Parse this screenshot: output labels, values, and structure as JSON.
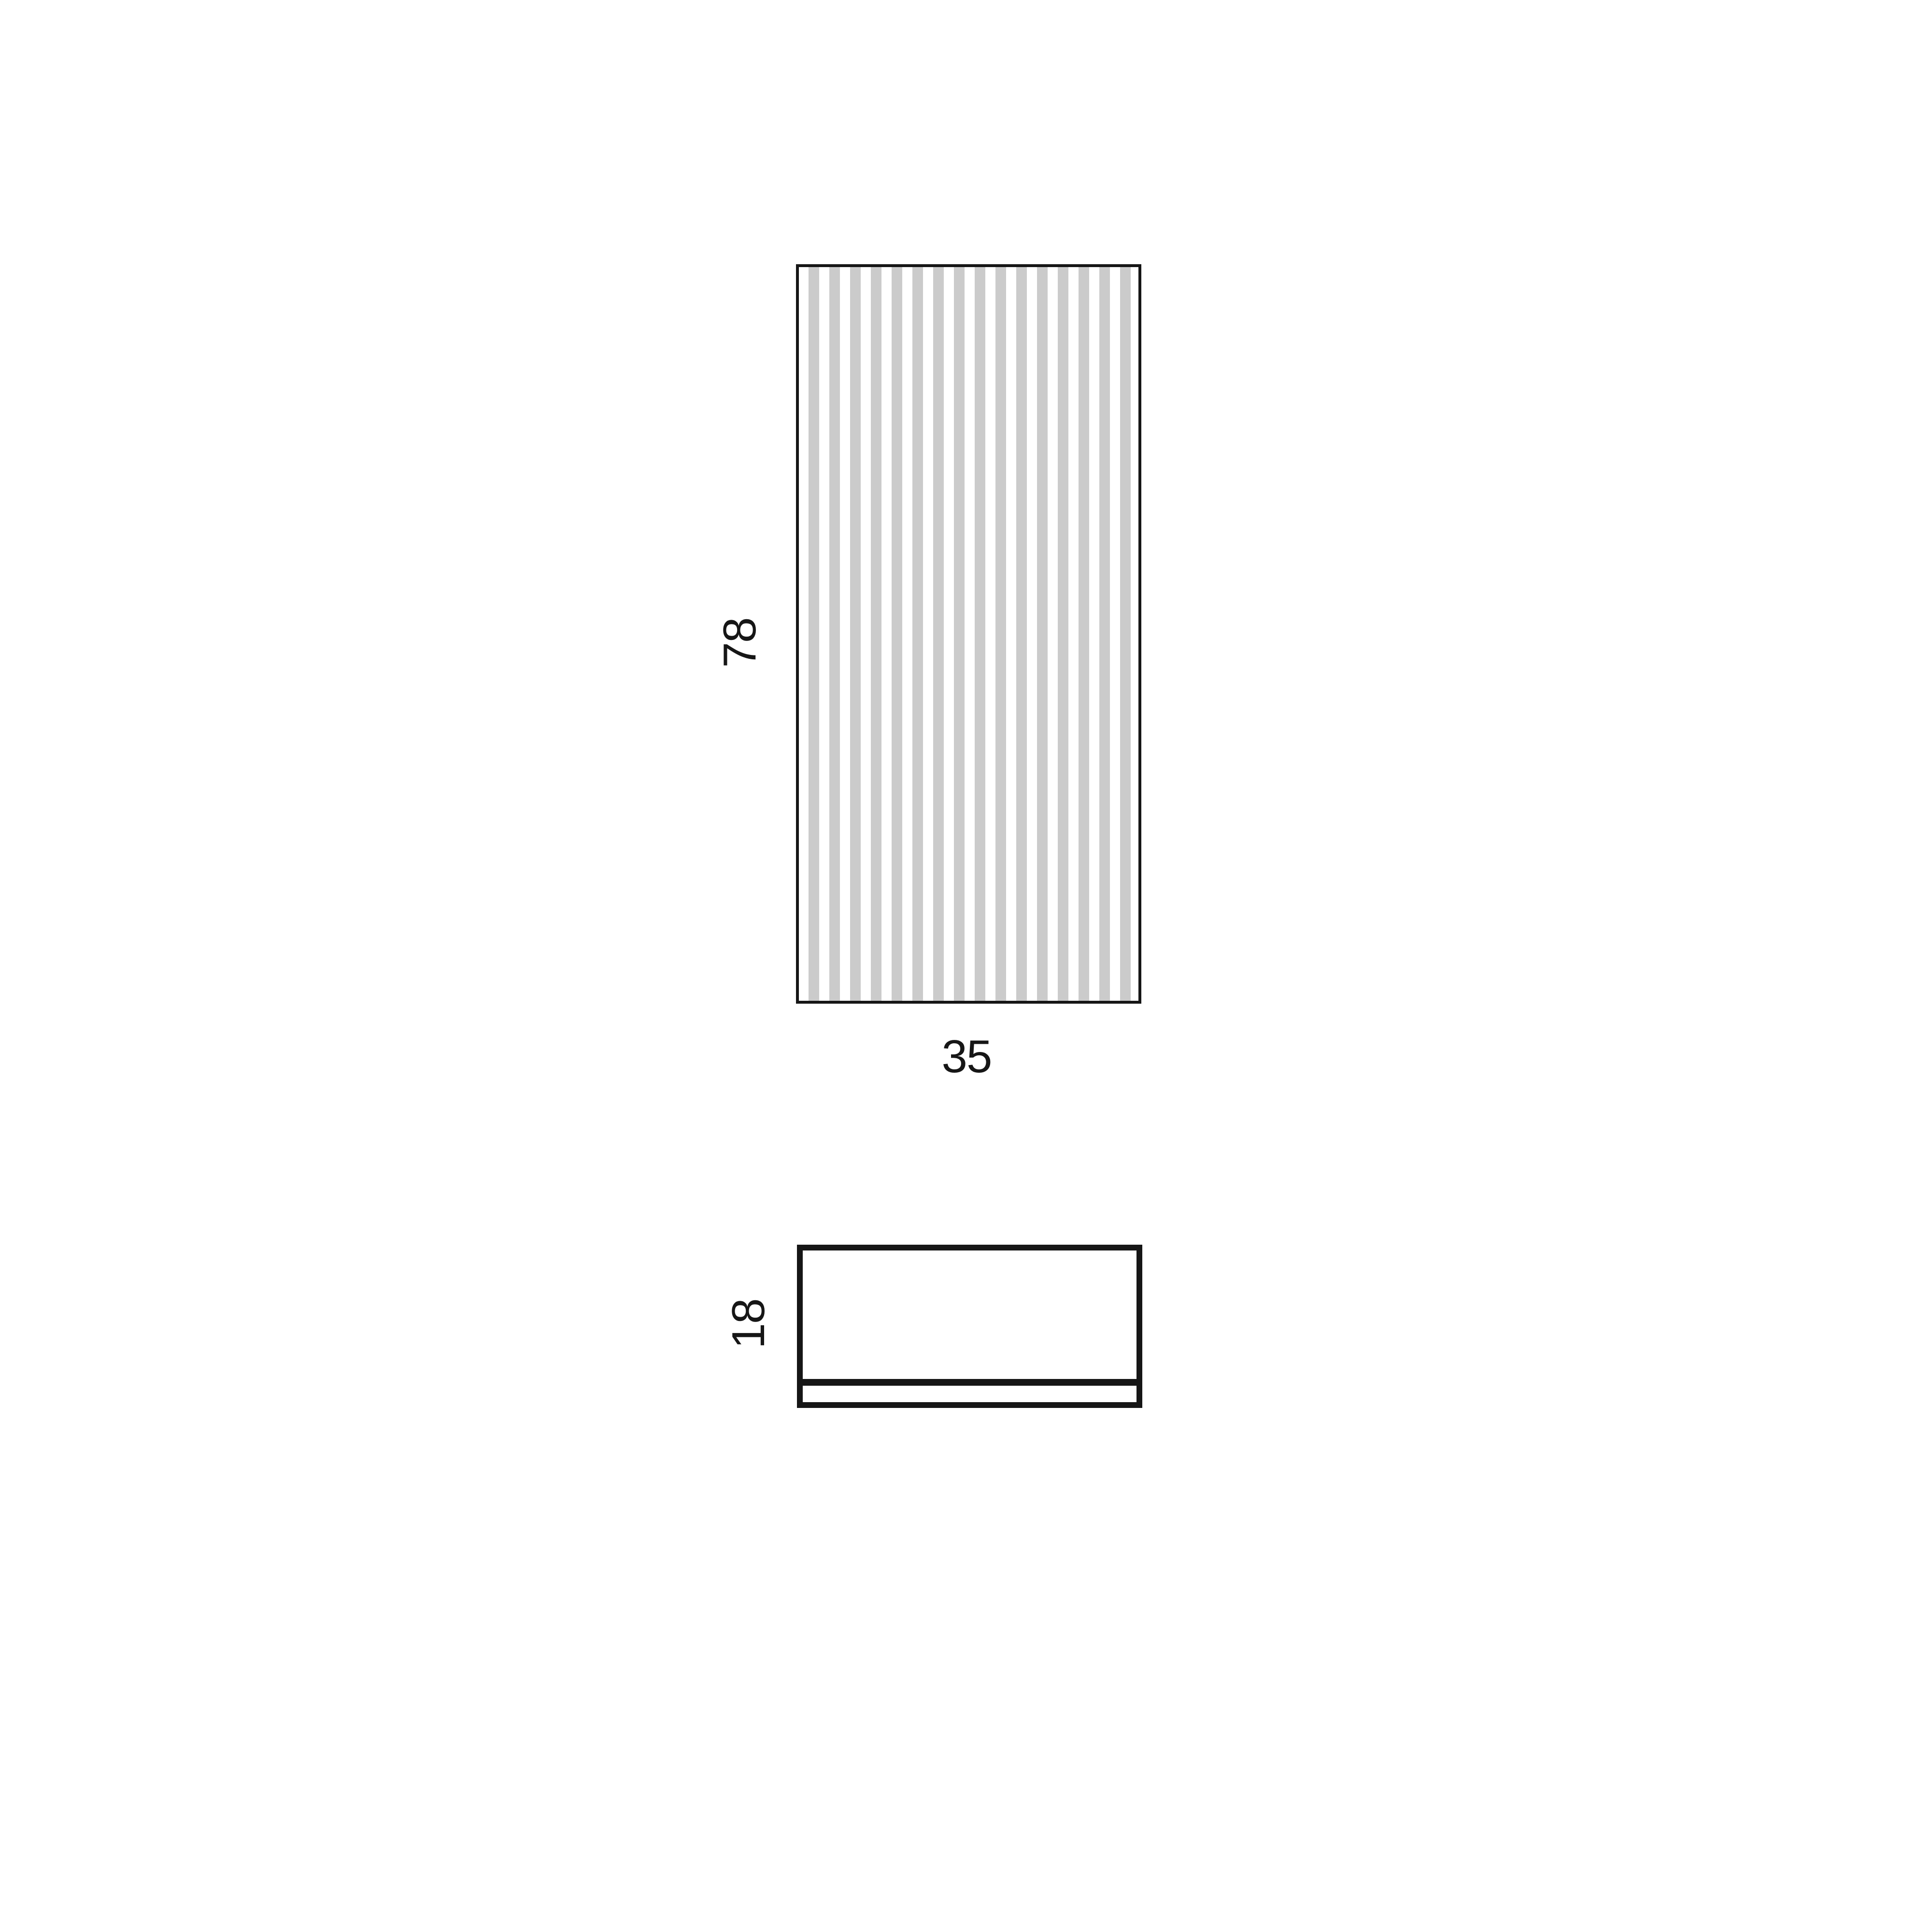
{
  "diagram": {
    "background_color": "#ffffff",
    "line_color": "#161616",
    "stripe_color": "#cbcbcb",
    "front_view": {
      "height_label": "78",
      "width_label": "35"
    },
    "top_view": {
      "depth_label": "18"
    }
  }
}
